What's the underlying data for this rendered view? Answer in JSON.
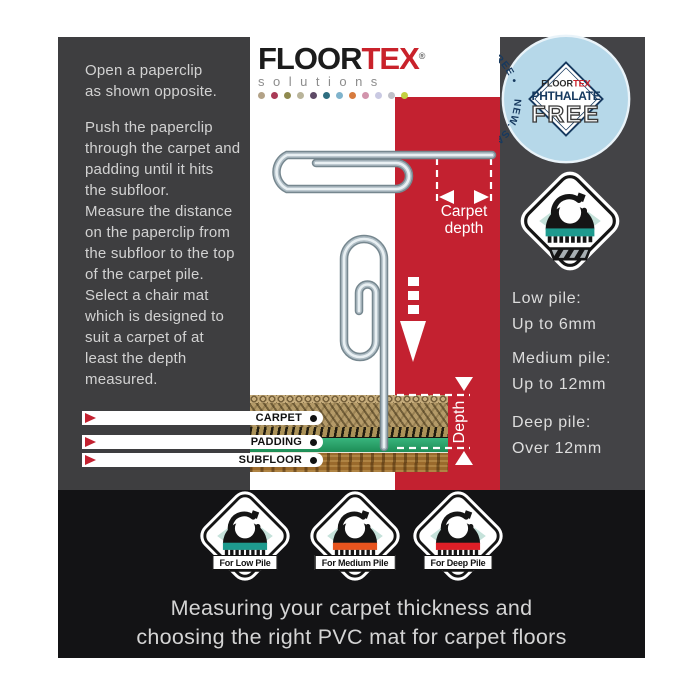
{
  "brand": {
    "logo_floor": "FLOOR",
    "logo_tex": "TEX",
    "logo_reg": "®",
    "logo_sub": "solutions",
    "dot_colors": [
      "#b3a287",
      "#a93a56",
      "#8f8a4e",
      "#b9b49a",
      "#5e4a66",
      "#2e6e80",
      "#7fb3cc",
      "#d77b3e",
      "#d294ac",
      "#c9c9e2",
      "#bfc0c8",
      "#c3d141"
    ]
  },
  "instructions": {
    "p1": [
      "Open a paperclip",
      "as shown opposite."
    ],
    "p2": [
      "Push the paperclip",
      "through the carpet and",
      "padding until it hits",
      "the subfloor."
    ],
    "p3": [
      "Measure the distance",
      "on the paperclip from",
      "the subfloor to the top",
      "of the carpet pile."
    ],
    "p4": [
      "Select a chair mat",
      "which is designed to",
      "suit a carpet of at",
      "least the depth",
      "measured."
    ]
  },
  "diagram": {
    "carpet_depth_line1": "Carpet",
    "carpet_depth_line2": "depth",
    "depth_label": "Depth",
    "layers": [
      {
        "label": "CARPET"
      },
      {
        "label": "PADDING"
      },
      {
        "label": "SUBFLOOR"
      }
    ]
  },
  "badge": {
    "arc_text": "NEW. SAFER PVC MATS  •  CADMIUM, LEAD & TIN FREE  •",
    "center_brand_floor": "FLOOR",
    "center_brand_tex": "TEX",
    "center_line1": "PHTHALATE",
    "center_line2": "FREE"
  },
  "pile_guide": [
    {
      "title": "Low pile:",
      "value": "Up to 6mm"
    },
    {
      "title": "Medium pile:",
      "value": "Up to 12mm"
    },
    {
      "title": "Deep pile:",
      "value": "Over 12mm"
    }
  ],
  "selector_icon": {
    "band_color": "#1e9a8e"
  },
  "mat_icons": [
    {
      "label": "For Low Pile",
      "band_color": "#1e9a8e"
    },
    {
      "label": "For Medium Pile",
      "band_color": "#e8541e"
    },
    {
      "label": "For Deep Pile",
      "band_color": "#df1f27"
    }
  ],
  "caption": {
    "line1": "Measuring your carpet thickness and",
    "line2": "choosing the right PVC mat for carpet floors"
  },
  "colors": {
    "accent_red": "#c32130",
    "panel_gray_left": "#3e3e40",
    "panel_gray_right": "#434346",
    "band_black": "#131315",
    "badge_blue": "#b6d8e9",
    "badge_navy": "#16395f",
    "padding_green": "#2aa16a",
    "metal_wire": "#76878f"
  }
}
